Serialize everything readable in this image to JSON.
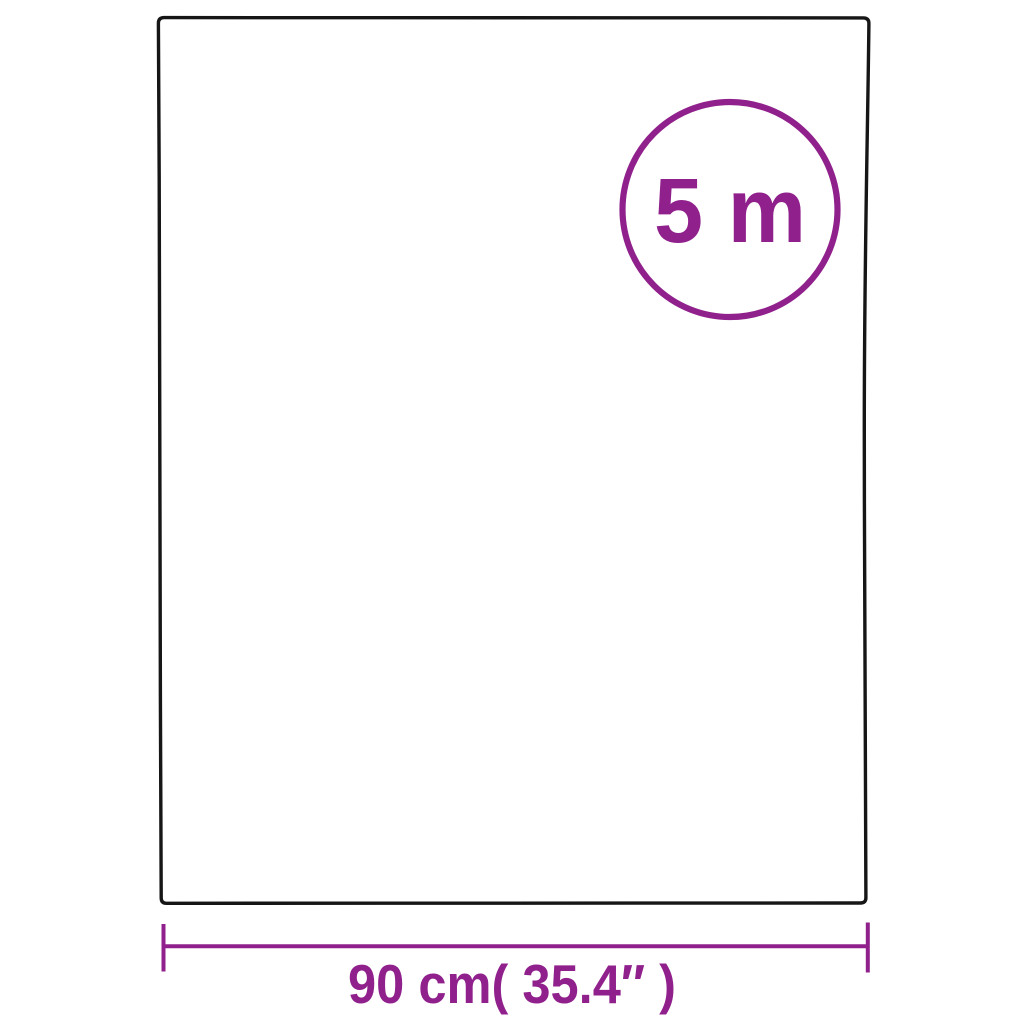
{
  "colors": {
    "accent": "#90218C",
    "outline": "#161616",
    "background": "#ffffff"
  },
  "diagram": {
    "type": "product-dimension-diagram",
    "roll_length_badge": "5 m",
    "width_dimension_label": "90 cm( 35.4″ )"
  }
}
